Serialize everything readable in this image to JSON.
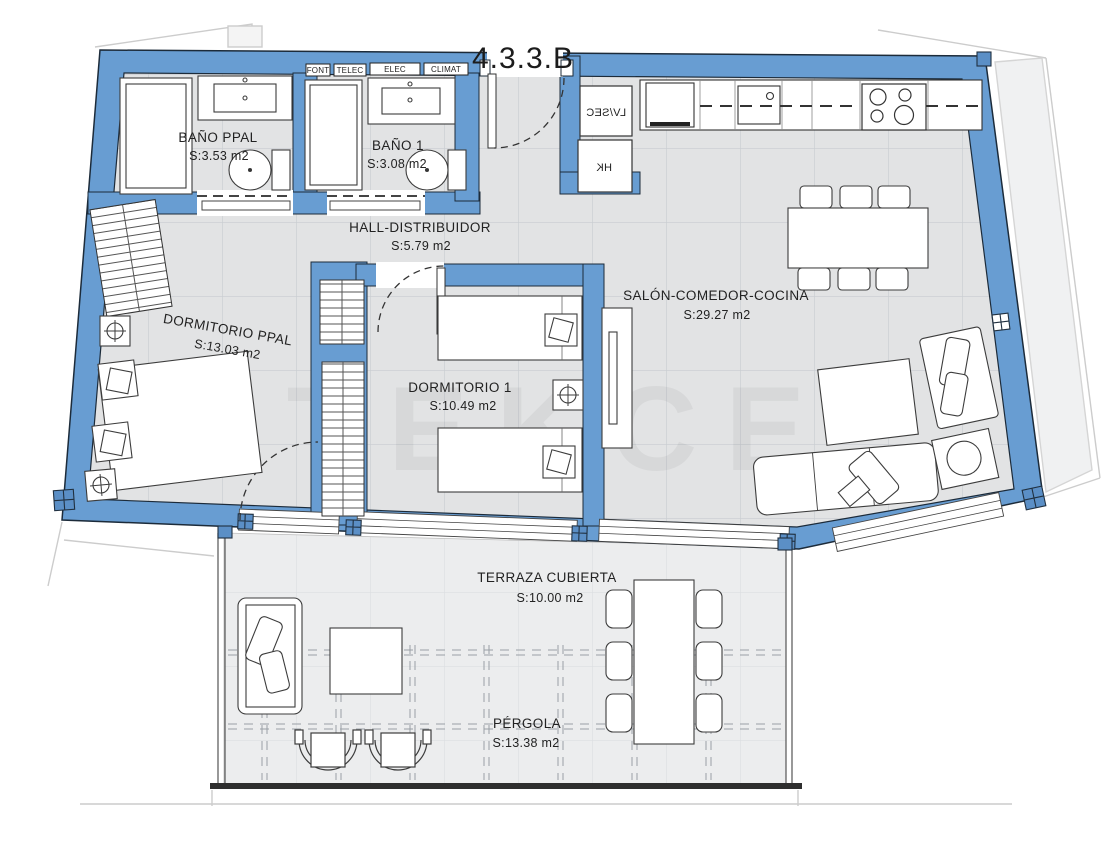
{
  "title": "4.3.3.B",
  "watermark": "TEKCE",
  "utility_tags": {
    "t1": "FONT",
    "t2": "TELEC",
    "t3": "ELEC",
    "t4": "CLIMAT"
  },
  "appliances": {
    "washer_dryer": "LV/SEC",
    "water_heater": "HK"
  },
  "rooms": {
    "bano_ppal": {
      "name": "BAÑO PPAL",
      "area": "S:3.53 m2"
    },
    "bano_1": {
      "name": "BAÑO 1",
      "area": "S:3.08 m2"
    },
    "hall": {
      "name": "HALL-DISTRIBUIDOR",
      "area": "S:5.79 m2"
    },
    "dorm_ppal": {
      "name": "DORMITORIO PPAL",
      "area": "S:13.03 m2"
    },
    "dorm_1": {
      "name": "DORMITORIO 1",
      "area": "S:10.49 m2"
    },
    "salon": {
      "name": "SALÓN-COMEDOR-COCINA",
      "area": "S:29.27 m2"
    },
    "terraza": {
      "name": "TERRAZA CUBIERTA",
      "area": "S:10.00 m2"
    },
    "pergola": {
      "name": "PÉRGOLA",
      "area": "S:13.38 m2"
    }
  },
  "colors": {
    "wall_fill": "#689DD2",
    "wall_outline": "#1c2b3a",
    "floor_tile": "#e2e3e4",
    "tile_line": "#c8ccd0",
    "terrace_tile": "#ecedee",
    "fixture_stroke": "#3c3c3c",
    "site_line": "#cccccc"
  }
}
